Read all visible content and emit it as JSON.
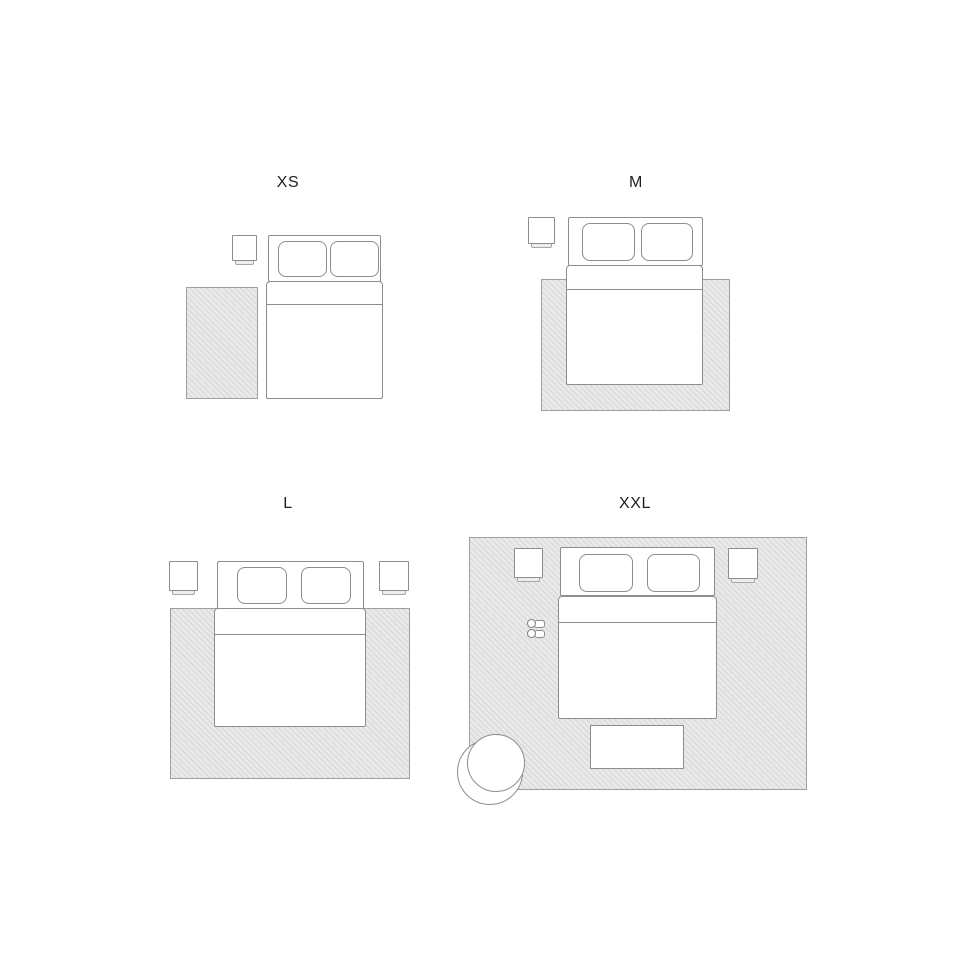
{
  "figure": {
    "type": "bedroom-rug-size-guide",
    "background": "#ffffff"
  },
  "colors": {
    "furniture_outline": "#8d8d8d",
    "rug_border": "#9e9e9e",
    "rug_fill": "#e9e9e9",
    "rug_hatch_line": "#d7d7d7",
    "label_text": "#1f1f1f"
  },
  "layouts": [
    {
      "label": "XS",
      "furniture": [
        "runner-rug-beside-bed",
        "nightstand",
        "double-bed-two-pillows"
      ]
    },
    {
      "label": "M",
      "furniture": [
        "rug-under-lower-bed",
        "nightstand",
        "double-bed-two-pillows"
      ]
    },
    {
      "label": "L",
      "furniture": [
        "rug-under-bed",
        "nightstand-left",
        "nightstand-right",
        "double-bed-two-pillows"
      ]
    },
    {
      "label": "XXL",
      "furniture": [
        "room-size-rug",
        "nightstand-left",
        "nightstand-right",
        "double-bed-two-pillows",
        "slippers",
        "foot-bench",
        "round-armchair"
      ]
    }
  ]
}
